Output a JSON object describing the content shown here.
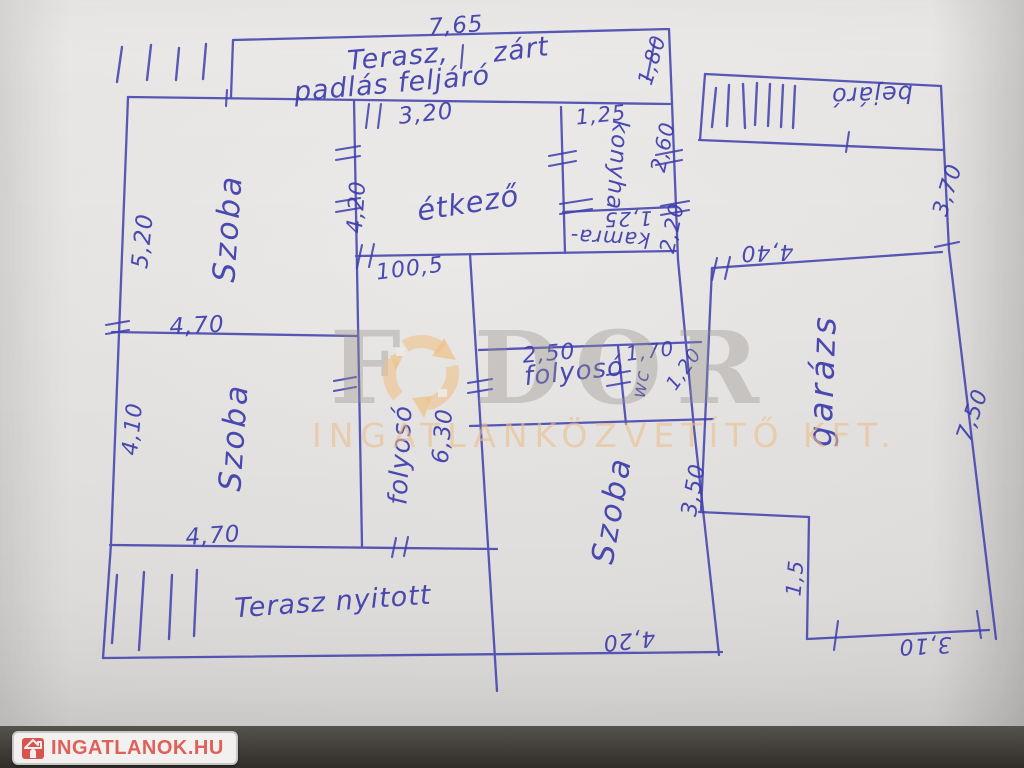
{
  "plan": {
    "room_labels": [
      {
        "id": "label-terasz-zart-word1",
        "text": "Terasz,",
        "x": 398,
        "y": 57,
        "rot": -5,
        "fs": 27
      },
      {
        "id": "label-terasz-zart-word2",
        "text": "zárt",
        "x": 521,
        "y": 50,
        "rot": -7,
        "fs": 27
      },
      {
        "id": "label-padlas-feljaro",
        "text": "padlás feljáró",
        "x": 392,
        "y": 84,
        "rot": -5,
        "fs": 27
      },
      {
        "id": "label-etkezo",
        "text": "étkező",
        "x": 468,
        "y": 203,
        "rot": -9,
        "fs": 29
      },
      {
        "id": "label-konyha",
        "text": "konyha",
        "x": 617,
        "y": 165,
        "rot": 94,
        "fs": 23
      },
      {
        "id": "label-kamra",
        "text": "kamra-",
        "x": 610,
        "y": 238,
        "rot": 183,
        "fs": 21
      },
      {
        "id": "label-szoba-top-left",
        "text": "Szoba",
        "x": 228,
        "y": 228,
        "rot": -86,
        "fs": 31,
        "ls": 3
      },
      {
        "id": "label-szoba-bottom-left",
        "text": "Szoba",
        "x": 234,
        "y": 437,
        "rot": -86,
        "fs": 31,
        "ls": 3
      },
      {
        "id": "label-folyoso-vertical",
        "text": "folyosó",
        "x": 401,
        "y": 455,
        "rot": -87,
        "fs": 26
      },
      {
        "id": "label-folyoso-horizontal",
        "text": "folyosó",
        "x": 574,
        "y": 372,
        "rot": -6,
        "fs": 26
      },
      {
        "id": "label-wc",
        "text": "wc",
        "x": 641,
        "y": 384,
        "rot": -80,
        "fs": 19
      },
      {
        "id": "label-szoba-bottom-middle",
        "text": "Szoba",
        "x": 612,
        "y": 510,
        "rot": -80,
        "fs": 31,
        "ls": 3
      },
      {
        "id": "label-terasz-nyitott",
        "text": "Terasz nyitott",
        "x": 333,
        "y": 602,
        "rot": -4,
        "fs": 27
      },
      {
        "id": "label-bejaro",
        "text": "bejáró",
        "x": 872,
        "y": 95,
        "rot": 178,
        "fs": 24
      },
      {
        "id": "label-garazs",
        "text": "garázs",
        "x": 822,
        "y": 380,
        "rot": -88,
        "fs": 33,
        "ls": 4
      }
    ],
    "dimension_labels": [
      {
        "id": "dim-terasz-width",
        "text": "7,65",
        "x": 456,
        "y": 26,
        "rot": -4,
        "fs": 23
      },
      {
        "id": "dim-terasz-height",
        "text": "1,80",
        "x": 652,
        "y": 60,
        "rot": -73,
        "fs": 21
      },
      {
        "id": "dim-etkezo-width",
        "text": "3,20",
        "x": 426,
        "y": 114,
        "rot": -6,
        "fs": 23
      },
      {
        "id": "dim-konyha-width",
        "text": "1,25",
        "x": 601,
        "y": 115,
        "rot": -6,
        "fs": 21
      },
      {
        "id": "dim-etkezo-height",
        "text": "4,20",
        "x": 357,
        "y": 207,
        "rot": -86,
        "fs": 22
      },
      {
        "id": "dim-konyha-height",
        "text": "2,60",
        "x": 663,
        "y": 147,
        "rot": -78,
        "fs": 21
      },
      {
        "id": "dim-kamra-height",
        "text": "2,20",
        "x": 672,
        "y": 228,
        "rot": -78,
        "fs": 21
      },
      {
        "id": "dim-kamra-width",
        "text": "1,25",
        "x": 628,
        "y": 219,
        "rot": 178,
        "fs": 20
      },
      {
        "id": "dim-szoba1-height",
        "text": "5,20",
        "x": 143,
        "y": 241,
        "rot": -84,
        "fs": 23
      },
      {
        "id": "dim-szoba-divider",
        "text": "4,70",
        "x": 197,
        "y": 326,
        "rot": -3,
        "fs": 23
      },
      {
        "id": "dim-szoba2-height",
        "text": "4,10",
        "x": 133,
        "y": 429,
        "rot": -84,
        "fs": 22
      },
      {
        "id": "dim-szoba2-width",
        "text": "4,70",
        "x": 213,
        "y": 536,
        "rot": -4,
        "fs": 23
      },
      {
        "id": "dim-etkezo-bottom",
        "text": "100,5",
        "x": 410,
        "y": 269,
        "rot": -7,
        "fs": 22
      },
      {
        "id": "dim-folyoso-height",
        "text": "6,30",
        "x": 443,
        "y": 436,
        "rot": -85,
        "fs": 23
      },
      {
        "id": "dim-folyoso-width",
        "text": "2,50",
        "x": 549,
        "y": 354,
        "rot": -5,
        "fs": 22
      },
      {
        "id": "dim-wc-width",
        "text": "1,70",
        "x": 650,
        "y": 351,
        "rot": -7,
        "fs": 20
      },
      {
        "id": "dim-wc-height",
        "text": "1,20",
        "x": 684,
        "y": 369,
        "rot": -55,
        "fs": 19
      },
      {
        "id": "dim-szoba3-height",
        "text": "3,50",
        "x": 694,
        "y": 490,
        "rot": -80,
        "fs": 22
      },
      {
        "id": "dim-szoba3-width",
        "text": "4,20",
        "x": 629,
        "y": 640,
        "rot": 174,
        "fs": 22
      },
      {
        "id": "dim-melleklet-felso",
        "text": "3,70",
        "x": 948,
        "y": 190,
        "rot": -73,
        "fs": 22
      },
      {
        "id": "dim-garazs-right",
        "text": "7,50",
        "x": 973,
        "y": 415,
        "rot": -70,
        "fs": 22
      },
      {
        "id": "dim-garazs-width",
        "text": "4,40",
        "x": 767,
        "y": 252,
        "rot": 178,
        "fs": 22
      },
      {
        "id": "dim-garazs-step",
        "text": "1,5",
        "x": 795,
        "y": 578,
        "rot": -85,
        "fs": 21
      },
      {
        "id": "dim-garazs-bottom",
        "text": "3,10",
        "x": 925,
        "y": 645,
        "rot": 177,
        "fs": 22
      }
    ]
  },
  "watermark": {
    "brand_left": "F",
    "brand_right": "DOR",
    "subtitle": "INGATLANKÖZVETÍTŐ KFT."
  },
  "footer": {
    "site_name": "INGATLANOK.HU"
  },
  "colors": {
    "ink": "#3c3cac",
    "watermark_gray": "#9b9691",
    "watermark_orange": "#eec28c",
    "footer_red": "#d9534f"
  }
}
